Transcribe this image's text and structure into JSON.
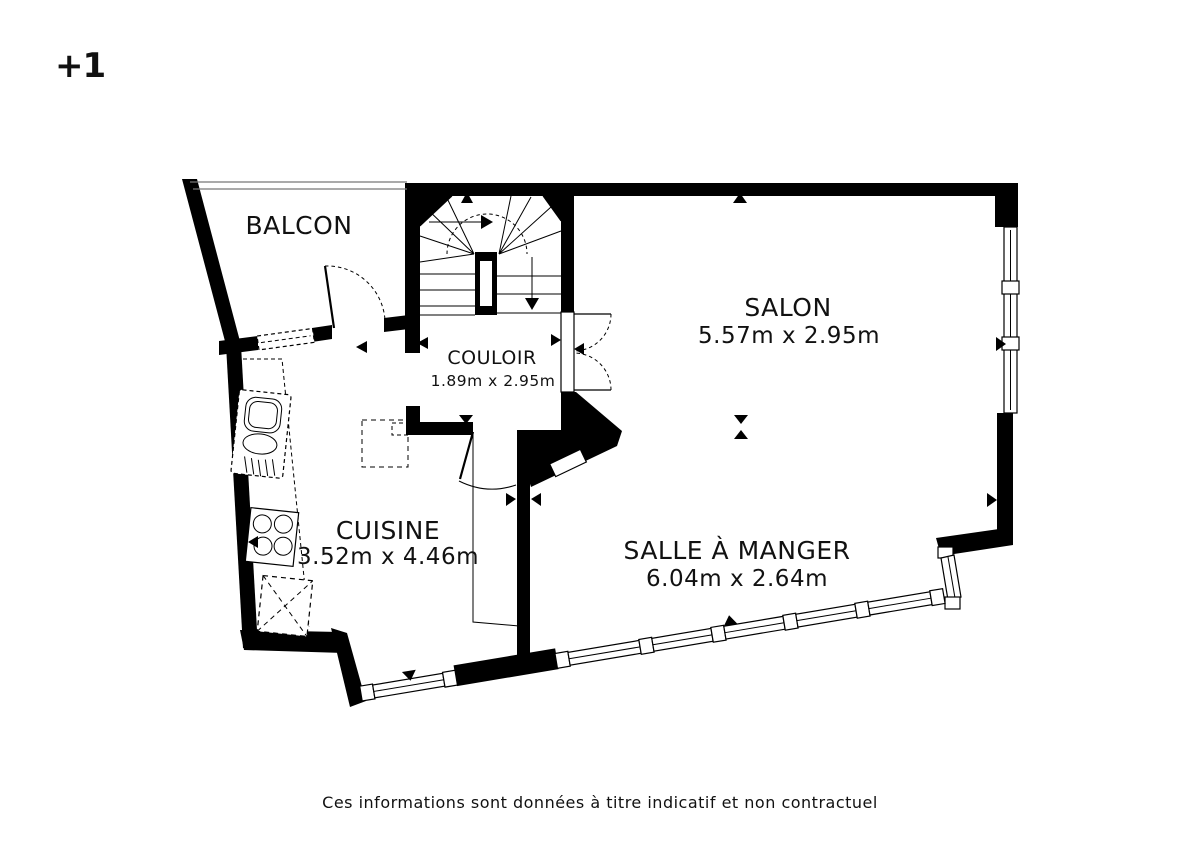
{
  "floor_label": "+1",
  "rooms": {
    "balcon": {
      "name": "BALCON"
    },
    "couloir": {
      "name": "COULOIR",
      "dims": "1.89m x 2.95m"
    },
    "salon": {
      "name": "SALON",
      "dims": "5.57m x 2.95m"
    },
    "cuisine": {
      "name": "CUISINE",
      "dims": "3.52m x 4.46m"
    },
    "salle_a_manger": {
      "name": "SALLE À MANGER",
      "dims": "6.04m x 2.64m"
    }
  },
  "footer": "Ces informations sont données à titre indicatif et non contractuel",
  "colors": {
    "wall": "#000000",
    "background": "#ffffff"
  }
}
